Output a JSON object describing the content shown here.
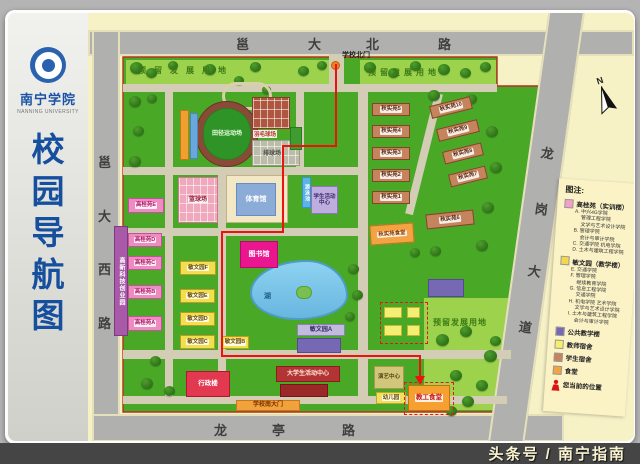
{
  "sidebar": {
    "university": "南宁学院",
    "university_en": "NANNING UNIVERSITY",
    "title_chars": [
      "校",
      "园",
      "导",
      "航",
      "图"
    ]
  },
  "compass_n": "N",
  "watermark": "头条号 / 南宁指南",
  "roads": {
    "labels": [
      {
        "t": "邕",
        "x": 236,
        "y": 34
      },
      {
        "t": "大",
        "x": 308,
        "y": 34
      },
      {
        "t": "北",
        "x": 366,
        "y": 34
      },
      {
        "t": "路",
        "x": 438,
        "y": 34
      },
      {
        "t": "邕",
        "x": 98,
        "y": 152
      },
      {
        "t": "大",
        "x": 98,
        "y": 206
      },
      {
        "t": "西",
        "x": 98,
        "y": 259
      },
      {
        "t": "路",
        "x": 98,
        "y": 313
      },
      {
        "t": "龙",
        "x": 214,
        "y": 420
      },
      {
        "t": "亭",
        "x": 272,
        "y": 420
      },
      {
        "t": "路",
        "x": 342,
        "y": 420
      },
      {
        "t": "龙",
        "x": 541,
        "y": 143,
        "r": 8
      },
      {
        "t": "岗",
        "x": 535,
        "y": 199,
        "r": 8
      },
      {
        "t": "大",
        "x": 528,
        "y": 261,
        "r": 8
      },
      {
        "t": "道",
        "x": 519,
        "y": 317,
        "r": 8
      }
    ]
  },
  "map": {
    "ground_polys": [
      {
        "points": "123,57 497,57 497,86 552,86 504,412 123,412",
        "fill": "#4aa827",
        "stroke": "#b43020"
      },
      {
        "points": "126,60 330,60 330,85 126,85",
        "fill": "#9cd24c"
      },
      {
        "points": "360,60 496,60 496,86 360,86",
        "fill": "#9cd24c"
      },
      {
        "points": "424,298 512,298 497,410 424,410",
        "fill": "#9cd24c"
      }
    ],
    "route": {
      "points": "336,64 336,146 283,146 283,232 222,232 222,356 420,356 420,379",
      "arrow": "420,385 415,376 425,376",
      "color": "#ef1010"
    },
    "paths": [
      [
        123,
        84,
        374,
        8
      ],
      [
        329,
        54,
        15,
        32
      ],
      [
        123,
        167,
        242,
        8
      ],
      [
        123,
        228,
        240,
        8
      ],
      [
        123,
        350,
        388,
        9
      ],
      [
        123,
        396,
        384,
        8
      ],
      [
        165,
        84,
        8,
        313
      ],
      [
        218,
        167,
        8,
        230
      ],
      [
        296,
        84,
        8,
        84
      ],
      [
        358,
        84,
        10,
        313
      ],
      [
        420,
        92,
        8,
        124,
        14
      ]
    ],
    "trees": [
      [
        130,
        62,
        13
      ],
      [
        146,
        68,
        11
      ],
      [
        168,
        61,
        10
      ],
      [
        204,
        64,
        12
      ],
      [
        250,
        62,
        11
      ],
      [
        298,
        66,
        11
      ],
      [
        317,
        61,
        10
      ],
      [
        364,
        62,
        12
      ],
      [
        388,
        68,
        11
      ],
      [
        410,
        61,
        11
      ],
      [
        438,
        64,
        12
      ],
      [
        460,
        68,
        11
      ],
      [
        480,
        62,
        11
      ],
      [
        129,
        96,
        12
      ],
      [
        133,
        126,
        11
      ],
      [
        129,
        156,
        12
      ],
      [
        147,
        94,
        10
      ],
      [
        234,
        76,
        10
      ],
      [
        262,
        86,
        9
      ],
      [
        428,
        90,
        12
      ],
      [
        466,
        94,
        11
      ],
      [
        486,
        126,
        12
      ],
      [
        490,
        162,
        12
      ],
      [
        482,
        202,
        12
      ],
      [
        476,
        240,
        12
      ],
      [
        430,
        246,
        11
      ],
      [
        410,
        248,
        10
      ],
      [
        348,
        264,
        11
      ],
      [
        352,
        290,
        11
      ],
      [
        345,
        312,
        10
      ],
      [
        436,
        334,
        13
      ],
      [
        460,
        326,
        12
      ],
      [
        484,
        350,
        13
      ],
      [
        450,
        370,
        12
      ],
      [
        432,
        390,
        12
      ],
      [
        462,
        396,
        12
      ],
      [
        490,
        336,
        11
      ],
      [
        476,
        380,
        12
      ],
      [
        446,
        406,
        11
      ],
      [
        150,
        356,
        11
      ],
      [
        141,
        378,
        12
      ],
      [
        164,
        386,
        11
      ]
    ],
    "buildings": [
      {
        "name": "lake",
        "x": 250,
        "y": 260,
        "w": 98,
        "h": 60,
        "cls": "lake"
      },
      {
        "name": "lake-island",
        "x": 296,
        "y": 286,
        "w": 16,
        "h": 13,
        "bg": "#7ac050",
        "bd": "#56a030",
        "rad": 8
      },
      {
        "name": "garden-ring",
        "x": 222,
        "y": 82,
        "w": 50,
        "h": 28,
        "bg": "transparent",
        "bd": "#d8d0a8",
        "rad": 24,
        "bw": 3
      },
      {
        "name": "track-ring",
        "x": 196,
        "y": 101,
        "w": 62,
        "h": 66,
        "bg": "#8a4a38",
        "bd": "#6a3224",
        "rad": 32
      },
      {
        "name": "track-field",
        "label": "田径运动场",
        "x": 203,
        "y": 108,
        "w": 48,
        "h": 52,
        "bg": "#2f9428",
        "bd": "#27801c",
        "rad": 26,
        "c": "#e8ffe0",
        "fs": 6
      },
      {
        "name": "grandstand",
        "x": 180,
        "y": 110,
        "w": 9,
        "h": 50,
        "bg": "#f0a030",
        "bd": "#c07818"
      },
      {
        "name": "grandstand-strip",
        "x": 190,
        "y": 113,
        "w": 8,
        "h": 46,
        "bg": "#6aa8dc",
        "bd": "#4888c0"
      },
      {
        "name": "basketball-courts",
        "label": "篮球场",
        "x": 178,
        "y": 177,
        "w": 40,
        "h": 46,
        "bg": "#f0a8bc",
        "bd": "#cc7890",
        "c": "#96203a",
        "fs": 6,
        "grid": 1,
        "strip": 1
      },
      {
        "name": "tennis-courts",
        "x": 252,
        "y": 97,
        "w": 38,
        "h": 32,
        "bg": "#ae5640",
        "bd": "#8a3c28",
        "grid": 1
      },
      {
        "name": "volleyball-courts",
        "x": 252,
        "y": 140,
        "w": 48,
        "h": 26,
        "bg": "#bcbcaa",
        "bd": "#9a9a88",
        "grid": 1
      },
      {
        "name": "green-court",
        "x": 290,
        "y": 127,
        "w": 12,
        "h": 23,
        "bg": "#3f9c30",
        "bd": "#2a7a1e"
      },
      {
        "name": "gymnasium",
        "x": 226,
        "y": 175,
        "w": 62,
        "h": 48,
        "bg": "#f2e8c6",
        "bd": "#c6b286"
      },
      {
        "name": "gymnasium-roof",
        "label": "体育馆",
        "x": 236,
        "y": 183,
        "w": 40,
        "h": 33,
        "bg": "#8cacd8",
        "bd": "#6a8cc0",
        "c": "#ffffff",
        "fs": 7
      },
      {
        "name": "gaogui-e",
        "label": "高桂苑E",
        "x": 128,
        "y": 198,
        "w": 36,
        "h": 15,
        "bg": "#ee8cc2",
        "bd": "#c0539a",
        "c": "#b01868",
        "fs": 5.5,
        "strip": 1
      },
      {
        "name": "gaogui-d",
        "label": "高桂苑D",
        "x": 128,
        "y": 233,
        "w": 34,
        "h": 14,
        "bg": "#ee8cc2",
        "bd": "#c0539a",
        "c": "#b01868",
        "fs": 5.5,
        "strip": 1
      },
      {
        "name": "gaogui-c",
        "label": "高桂苑C",
        "x": 128,
        "y": 256,
        "w": 34,
        "h": 14,
        "bg": "#ee8cc2",
        "bd": "#c0539a",
        "c": "#b01868",
        "fs": 5.5,
        "strip": 1
      },
      {
        "name": "gaogui-b",
        "label": "高桂苑B",
        "x": 128,
        "y": 285,
        "w": 34,
        "h": 14,
        "bg": "#ee8cc2",
        "bd": "#c0539a",
        "c": "#b01868",
        "fs": 5.5,
        "strip": 1
      },
      {
        "name": "gaogui-a",
        "label": "高桂苑A",
        "x": 128,
        "y": 316,
        "w": 34,
        "h": 15,
        "bg": "#ee8cc2",
        "bd": "#c0539a",
        "c": "#b01868",
        "fs": 5.5,
        "strip": 1
      },
      {
        "name": "hitech-park",
        "label": "高新科技创业园",
        "x": 114,
        "y": 226,
        "w": 14,
        "h": 110,
        "bg": "#a85aa8",
        "bd": "#7c3a7c",
        "c": "#ffffff",
        "fs": 6,
        "vert": 1
      },
      {
        "name": "minwen-f",
        "label": "敏文园F",
        "x": 180,
        "y": 261,
        "w": 36,
        "h": 14,
        "bg": "#f2df4e",
        "bd": "#c09a28",
        "c": "#6a4a08",
        "fs": 5.5,
        "strip": 1
      },
      {
        "name": "minwen-e",
        "label": "敏文园E",
        "x": 180,
        "y": 289,
        "w": 35,
        "h": 14,
        "bg": "#f2df4e",
        "bd": "#c09a28",
        "c": "#6a4a08",
        "fs": 5.5,
        "strip": 1
      },
      {
        "name": "minwen-d",
        "label": "敏文园D",
        "x": 180,
        "y": 312,
        "w": 35,
        "h": 14,
        "bg": "#f2df4e",
        "bd": "#c09a28",
        "c": "#6a4a08",
        "fs": 5.5,
        "strip": 1
      },
      {
        "name": "minwen-c",
        "label": "敏文园C",
        "x": 180,
        "y": 335,
        "w": 35,
        "h": 14,
        "bg": "#f2df4e",
        "bd": "#c09a28",
        "c": "#6a4a08",
        "fs": 5.5,
        "strip": 1
      },
      {
        "name": "minwen-b",
        "label": "敏文园B",
        "x": 221,
        "y": 336,
        "w": 28,
        "h": 13,
        "bg": "#f2df4e",
        "bd": "#c09a28",
        "c": "#6a4a08",
        "fs": 5.5,
        "strip": 1
      },
      {
        "name": "minwen-a",
        "label": "敏文园A",
        "x": 297,
        "y": 324,
        "w": 48,
        "h": 12,
        "bg": "#c2bcdc",
        "bd": "#8a82b8",
        "c": "#3a2a6a",
        "fs": 6
      },
      {
        "name": "public-teaching-1",
        "x": 297,
        "y": 338,
        "w": 44,
        "h": 15,
        "bg": "#7668b2",
        "bd": "#564898"
      },
      {
        "name": "public-teaching-2",
        "x": 428,
        "y": 279,
        "w": 36,
        "h": 18,
        "bg": "#7668b2",
        "bd": "#564898"
      },
      {
        "name": "library",
        "label": "图书馆",
        "x": 240,
        "y": 241,
        "w": 38,
        "h": 27,
        "bg": "#ea1690",
        "bd": "#b80a6a",
        "c": "#ffffff",
        "fs": 7
      },
      {
        "name": "student-activity-center",
        "label": "学生活动中心",
        "x": 311,
        "y": 186,
        "w": 27,
        "h": 28,
        "bg": "#beaede",
        "bd": "#8a76b8",
        "c": "#3a2a6a",
        "fs": 5.5,
        "wrap": 1
      },
      {
        "name": "swimming-pool",
        "label": "游泳池",
        "x": 302,
        "y": 177,
        "w": 9,
        "h": 31,
        "bg": "#5ab4e8",
        "bd": "#3a94c8",
        "c": "#ffffff",
        "fs": 5,
        "vert": 1
      },
      {
        "name": "admin-building",
        "label": "行政楼",
        "x": 186,
        "y": 371,
        "w": 44,
        "h": 26,
        "bg": "#e23850",
        "bd": "#b01830",
        "c": "#ffffff",
        "fs": 6.5
      },
      {
        "name": "dorm-5",
        "label": "秋实苑5",
        "x": 372,
        "y": 103,
        "w": 38,
        "h": 13,
        "bg": "#c6845c",
        "bd": "#7c4828",
        "c": "#5a2810",
        "fs": 5.5,
        "strip": 1
      },
      {
        "name": "dorm-4",
        "label": "秋实苑4",
        "x": 372,
        "y": 125,
        "w": 38,
        "h": 13,
        "bg": "#c6845c",
        "bd": "#7c4828",
        "c": "#5a2810",
        "fs": 5.5,
        "strip": 1
      },
      {
        "name": "dorm-3",
        "label": "秋实苑3",
        "x": 372,
        "y": 147,
        "w": 38,
        "h": 13,
        "bg": "#c6845c",
        "bd": "#7c4828",
        "c": "#5a2810",
        "fs": 5.5,
        "strip": 1
      },
      {
        "name": "dorm-2",
        "label": "秋实苑2",
        "x": 372,
        "y": 169,
        "w": 38,
        "h": 13,
        "bg": "#c6845c",
        "bd": "#7c4828",
        "c": "#5a2810",
        "fs": 5.5,
        "strip": 1
      },
      {
        "name": "dorm-1",
        "label": "秋实苑1",
        "x": 372,
        "y": 191,
        "w": 38,
        "h": 13,
        "bg": "#c6845c",
        "bd": "#7c4828",
        "c": "#5a2810",
        "fs": 5.5,
        "strip": 1
      },
      {
        "name": "dorm-10",
        "label": "秋实苑10",
        "x": 430,
        "y": 101,
        "w": 42,
        "h": 13,
        "bg": "#c6845c",
        "bd": "#7c4828",
        "c": "#5a2810",
        "fs": 5.5,
        "strip": 1,
        "rot": -14
      },
      {
        "name": "dorm-9",
        "label": "秋实苑9",
        "x": 437,
        "y": 124,
        "w": 42,
        "h": 13,
        "bg": "#c6845c",
        "bd": "#7c4828",
        "c": "#5a2810",
        "fs": 5.5,
        "strip": 1,
        "rot": -14
      },
      {
        "name": "dorm-8",
        "label": "秋实苑8",
        "x": 443,
        "y": 147,
        "w": 40,
        "h": 13,
        "bg": "#c6845c",
        "bd": "#7c4828",
        "c": "#5a2810",
        "fs": 5.5,
        "strip": 1,
        "rot": -14
      },
      {
        "name": "dorm-7",
        "label": "秋实苑7",
        "x": 449,
        "y": 170,
        "w": 38,
        "h": 13,
        "bg": "#c6845c",
        "bd": "#7c4828",
        "c": "#5a2810",
        "fs": 5.5,
        "strip": 1,
        "rot": -14
      },
      {
        "name": "dorm-6",
        "label": "秋实苑6",
        "x": 426,
        "y": 212,
        "w": 48,
        "h": 15,
        "bg": "#c6845c",
        "bd": "#7c4828",
        "c": "#5a2810",
        "fs": 5.5,
        "strip": 1,
        "rot": -6
      },
      {
        "name": "dorm-canteen",
        "label": "秋实苑食堂",
        "x": 370,
        "y": 224,
        "w": 44,
        "h": 20,
        "bg": "#f2a343",
        "bd": "#bc7418",
        "c": "#8a3a00",
        "fs": 5.5,
        "strip": 1,
        "rot": -4
      },
      {
        "name": "teacher-dorm-1",
        "x": 384,
        "y": 307,
        "w": 18,
        "h": 11,
        "bg": "#f3ee74",
        "bd": "#c4b62e"
      },
      {
        "name": "teacher-dorm-2",
        "x": 407,
        "y": 307,
        "w": 13,
        "h": 11,
        "bg": "#f3ee74",
        "bd": "#c4b62e"
      },
      {
        "name": "teacher-dorm-3",
        "x": 384,
        "y": 325,
        "w": 18,
        "h": 11,
        "bg": "#f3ee74",
        "bd": "#c4b62e"
      },
      {
        "name": "teacher-dorm-4",
        "x": 407,
        "y": 325,
        "w": 13,
        "h": 11,
        "bg": "#f3ee74",
        "bd": "#c4b62e"
      },
      {
        "name": "performing-arts-center",
        "label": "演艺中心",
        "x": 374,
        "y": 366,
        "w": 30,
        "h": 23,
        "bg": "#d2c67c",
        "bd": "#a89a4a",
        "c": "#564a10",
        "fs": 5.5,
        "wrap": 1
      },
      {
        "name": "kindergarten",
        "label": "幼儿园",
        "x": 376,
        "y": 392,
        "w": 30,
        "h": 12,
        "bg": "#f0e060",
        "bd": "#c0a830",
        "c": "#6a4a08",
        "fs": 5.5,
        "strip": 1
      },
      {
        "name": "staff-canteen",
        "label": "教工食堂",
        "x": 408,
        "y": 385,
        "w": 42,
        "h": 26,
        "bg": "#f5a030",
        "bd": "#c87010",
        "c": "#c41414",
        "fs": 6.5,
        "strip": 1
      },
      {
        "name": "univ-student-activity-center",
        "label": "大学生活动中心",
        "x": 276,
        "y": 366,
        "w": 64,
        "h": 16,
        "bg": "#b23434",
        "bd": "#8a1c1c",
        "c": "#ffe8d8",
        "fs": 6
      },
      {
        "name": "auditorium",
        "x": 280,
        "y": 384,
        "w": 48,
        "h": 13,
        "bg": "#9a2828",
        "bd": "#781414"
      },
      {
        "name": "south-gate",
        "label": "学校南大门",
        "x": 236,
        "y": 400,
        "w": 64,
        "h": 11,
        "bg": "#f2a23c",
        "bd": "#c87818",
        "c": "#7a3000",
        "fs": 6
      },
      {
        "name": "north-gate-dot",
        "x": 331,
        "y": 61,
        "w": 9,
        "h": 9,
        "bg": "#f08020",
        "bd": "#c05a10",
        "rad": 9
      }
    ],
    "texts": [
      {
        "t": "学校北门",
        "x": 342,
        "y": 50,
        "fs": 7,
        "c": "#222222"
      },
      {
        "t": "预留发展用地",
        "x": 138,
        "y": 65,
        "fs": 8,
        "c": "#3c7a14",
        "ls": 8
      },
      {
        "t": "预留发展用地",
        "x": 368,
        "y": 67,
        "fs": 8,
        "c": "#3c7a14",
        "ls": 4
      },
      {
        "t": "预留发展用地",
        "x": 433,
        "y": 317,
        "fs": 8,
        "c": "#3c7a14",
        "ls": 1
      },
      {
        "t": "湖",
        "x": 264,
        "y": 291,
        "fs": 7,
        "c": "#1a5a8a"
      },
      {
        "t": "羽毛球场",
        "x": 253,
        "y": 130,
        "fs": 5.5,
        "c": "#c03030",
        "bgw": 1
      },
      {
        "t": "排球场",
        "x": 263,
        "y": 148,
        "fs": 6,
        "c": "#50504a"
      }
    ],
    "highlights": [
      [
        380,
        302,
        46,
        40
      ],
      [
        404,
        382,
        48,
        31
      ]
    ]
  },
  "legend": {
    "title": "图注:",
    "groups": [
      {
        "color": "#f2a0c8",
        "label": "高桂苑（实训楼）",
        "subs": [
          "A. 中兴4G学院",
          "　 管理工程学院",
          "　 文学与艺术设计学院",
          "B. 管理学院",
          "　 会计与审计学院",
          "C. 交通学院 机电学院",
          "D. 土木与建筑工程学院"
        ]
      },
      {
        "color": "#f2d84e",
        "label": "敏文园（教学楼）",
        "subs": [
          "E. 交通学院",
          "F. 管理学院",
          "　 继续教育学院",
          "G. 信息工程学院",
          "　 交通学院",
          "H. 机电学院 艺术学院",
          "　 文学与艺术设计学院",
          "I. 土木与建筑工程学院",
          "　 会计与审计学院"
        ]
      },
      {
        "color": "#7668b2",
        "label": "公共教学楼"
      },
      {
        "color": "#f5ef6a",
        "label": "教师宿舍"
      },
      {
        "color": "#c6845c",
        "label": "学生宿舍"
      },
      {
        "color": "#f2a343",
        "label": "食堂"
      },
      {
        "icon": "person",
        "color": "#d81414",
        "label": "您当前的位置"
      }
    ]
  }
}
